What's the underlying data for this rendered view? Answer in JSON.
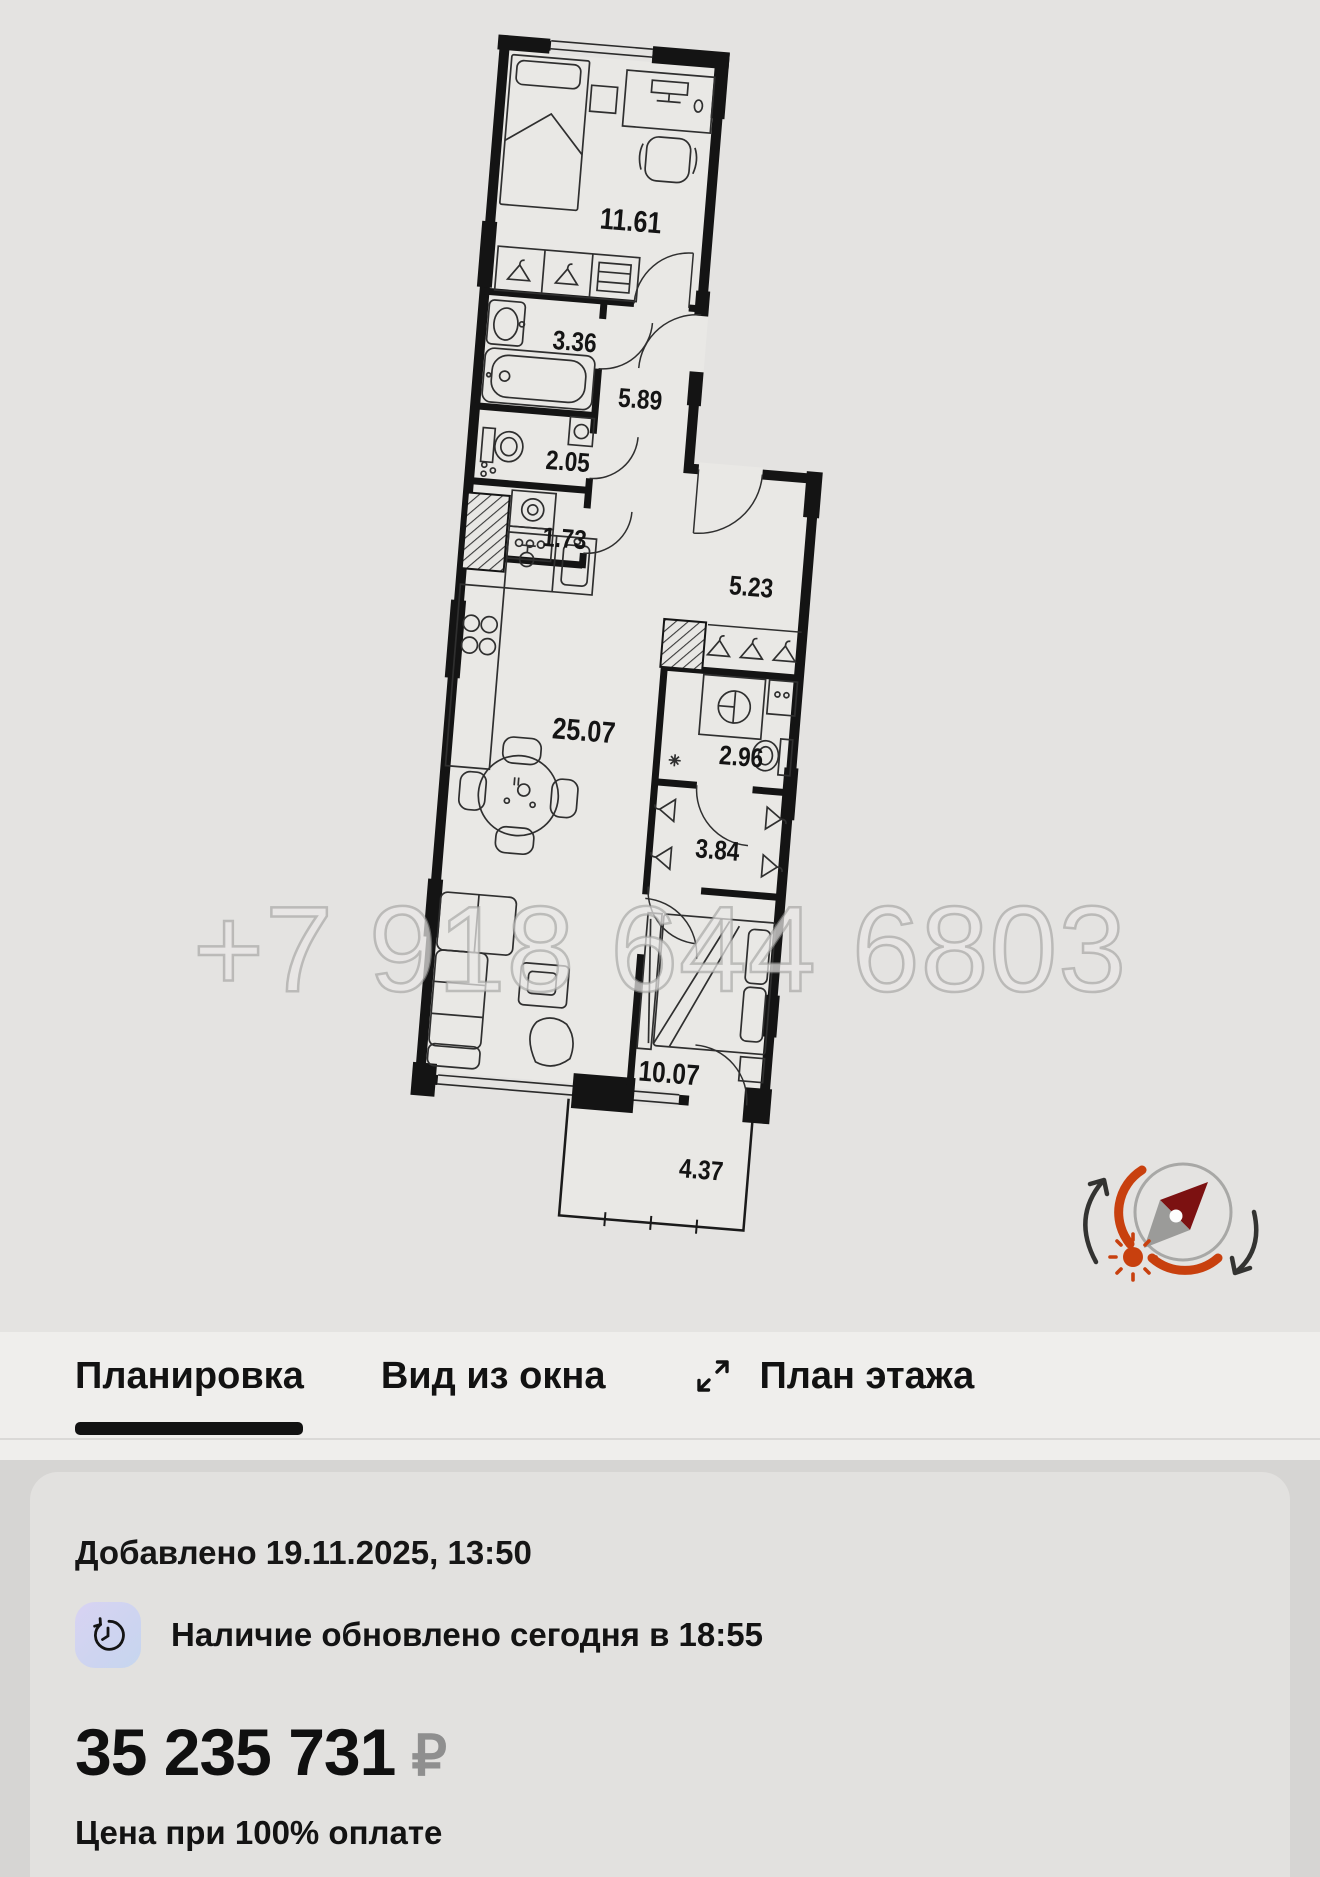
{
  "floor_plan": {
    "watermark": "+7 918 644 6803",
    "rooms": [
      {
        "name": "bedroom-top",
        "area": "11.61"
      },
      {
        "name": "bathroom",
        "area": "3.36"
      },
      {
        "name": "hallway",
        "area": "5.89"
      },
      {
        "name": "wc",
        "area": "2.05"
      },
      {
        "name": "laundry",
        "area": "1.73"
      },
      {
        "name": "entry-corridor",
        "area": "5.23"
      },
      {
        "name": "living-kitchen",
        "area": "25.07"
      },
      {
        "name": "shower-room",
        "area": "2.96"
      },
      {
        "name": "wardrobe",
        "area": "3.84"
      },
      {
        "name": "bedroom",
        "area": "10.07"
      },
      {
        "name": "balcony",
        "area": "4.37"
      }
    ],
    "compass": {
      "arc_color": "#c8400e",
      "needle_color": "#7c1111",
      "ring_color": "#a8a8a6"
    }
  },
  "tabs": {
    "items": [
      {
        "label": "Планировка",
        "active": true
      },
      {
        "label": "Вид из окна",
        "active": false
      },
      {
        "label": "План этажа",
        "active": false
      }
    ]
  },
  "info": {
    "added": "Добавлено 19.11.2025, 13:50",
    "availability": "Наличие обновлено сегодня в 18:55",
    "price": "35 235 731",
    "currency": "₽",
    "price_note": "Цена при 100% оплате"
  }
}
